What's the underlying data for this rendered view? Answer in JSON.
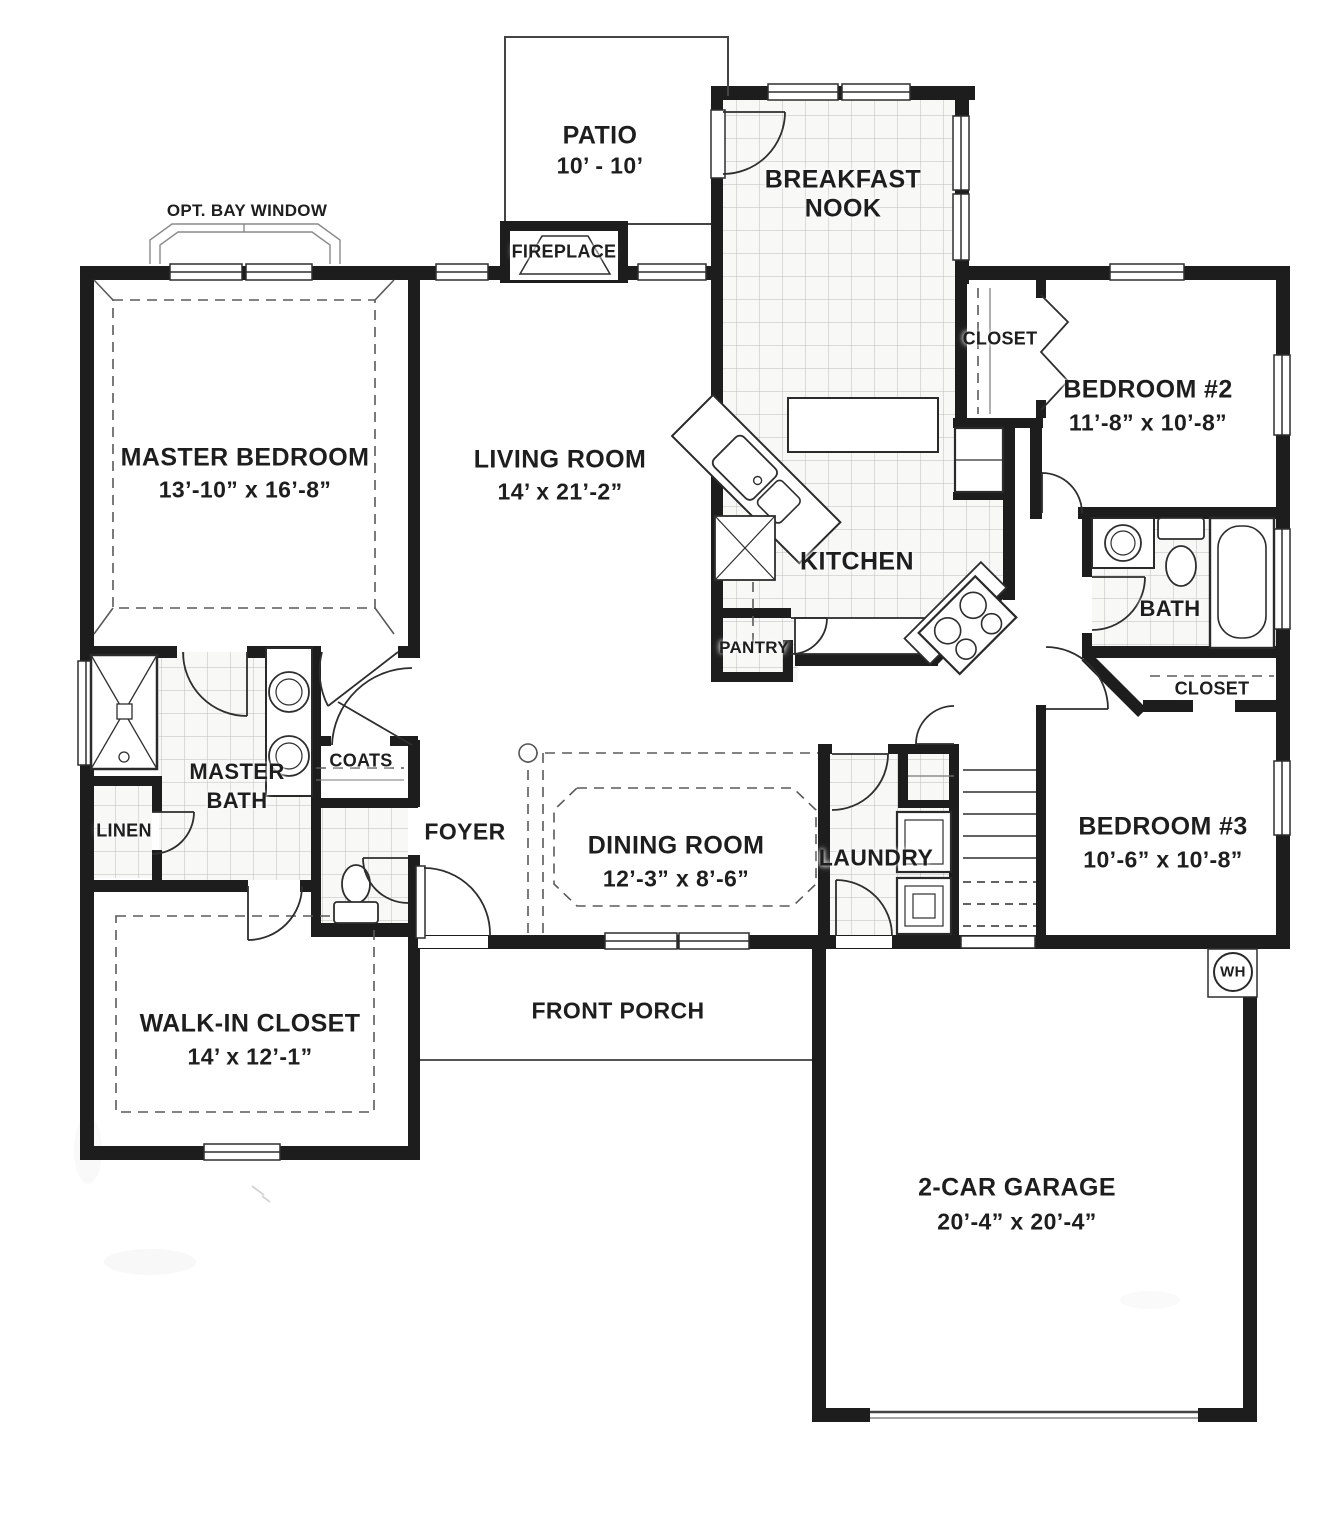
{
  "title": "Single-story house floor plan",
  "colors": {
    "wall": "#1d1d1d",
    "line": "#2e2e2e",
    "dash": "#5a5a5a",
    "tile_line": "#bcbcb9",
    "paper": "#ffffff"
  },
  "rooms": {
    "patio": {
      "label": "PATIO",
      "dims": "10’ - 10’"
    },
    "breakfast_nook": {
      "line1": "BREAKFAST",
      "line2": "NOOK"
    },
    "master_bedroom": {
      "label": "MASTER BEDROOM",
      "dims": "13’-10” x 16’-8”"
    },
    "living_room": {
      "label": "LIVING ROOM",
      "dims": "14’ x 21’-2”"
    },
    "kitchen": {
      "label": "KITCHEN"
    },
    "pantry": {
      "label": "PANTRY"
    },
    "bedroom2": {
      "label": "BEDROOM #2",
      "dims": "11’-8” x 10’-8”"
    },
    "bedroom2_closet": {
      "label": "CLOSET"
    },
    "bath": {
      "label": "BATH"
    },
    "hall_closet": {
      "label": "CLOSET"
    },
    "master_bath": {
      "line1": "MASTER",
      "line2": "BATH"
    },
    "linen": {
      "label": "LINEN"
    },
    "coats": {
      "label": "COATS"
    },
    "foyer": {
      "label": "FOYER"
    },
    "dining_room": {
      "label": "DINING ROOM",
      "dims": "12’-3” x 8’-6”"
    },
    "laundry": {
      "label": "LAUNDRY"
    },
    "bedroom3": {
      "label": "BEDROOM #3",
      "dims": "10’-6” x 10’-8”"
    },
    "walk_in_closet": {
      "label": "WALK-IN CLOSET",
      "dims": "14’ x 12’-1”"
    },
    "front_porch": {
      "label": "FRONT PORCH"
    },
    "garage": {
      "label": "2-CAR GARAGE",
      "dims": "20’-4” x 20’-4”"
    }
  },
  "annotations": {
    "bay_window": "OPT. BAY WINDOW",
    "fireplace": "FIREPLACE",
    "water_heater": "WH"
  }
}
